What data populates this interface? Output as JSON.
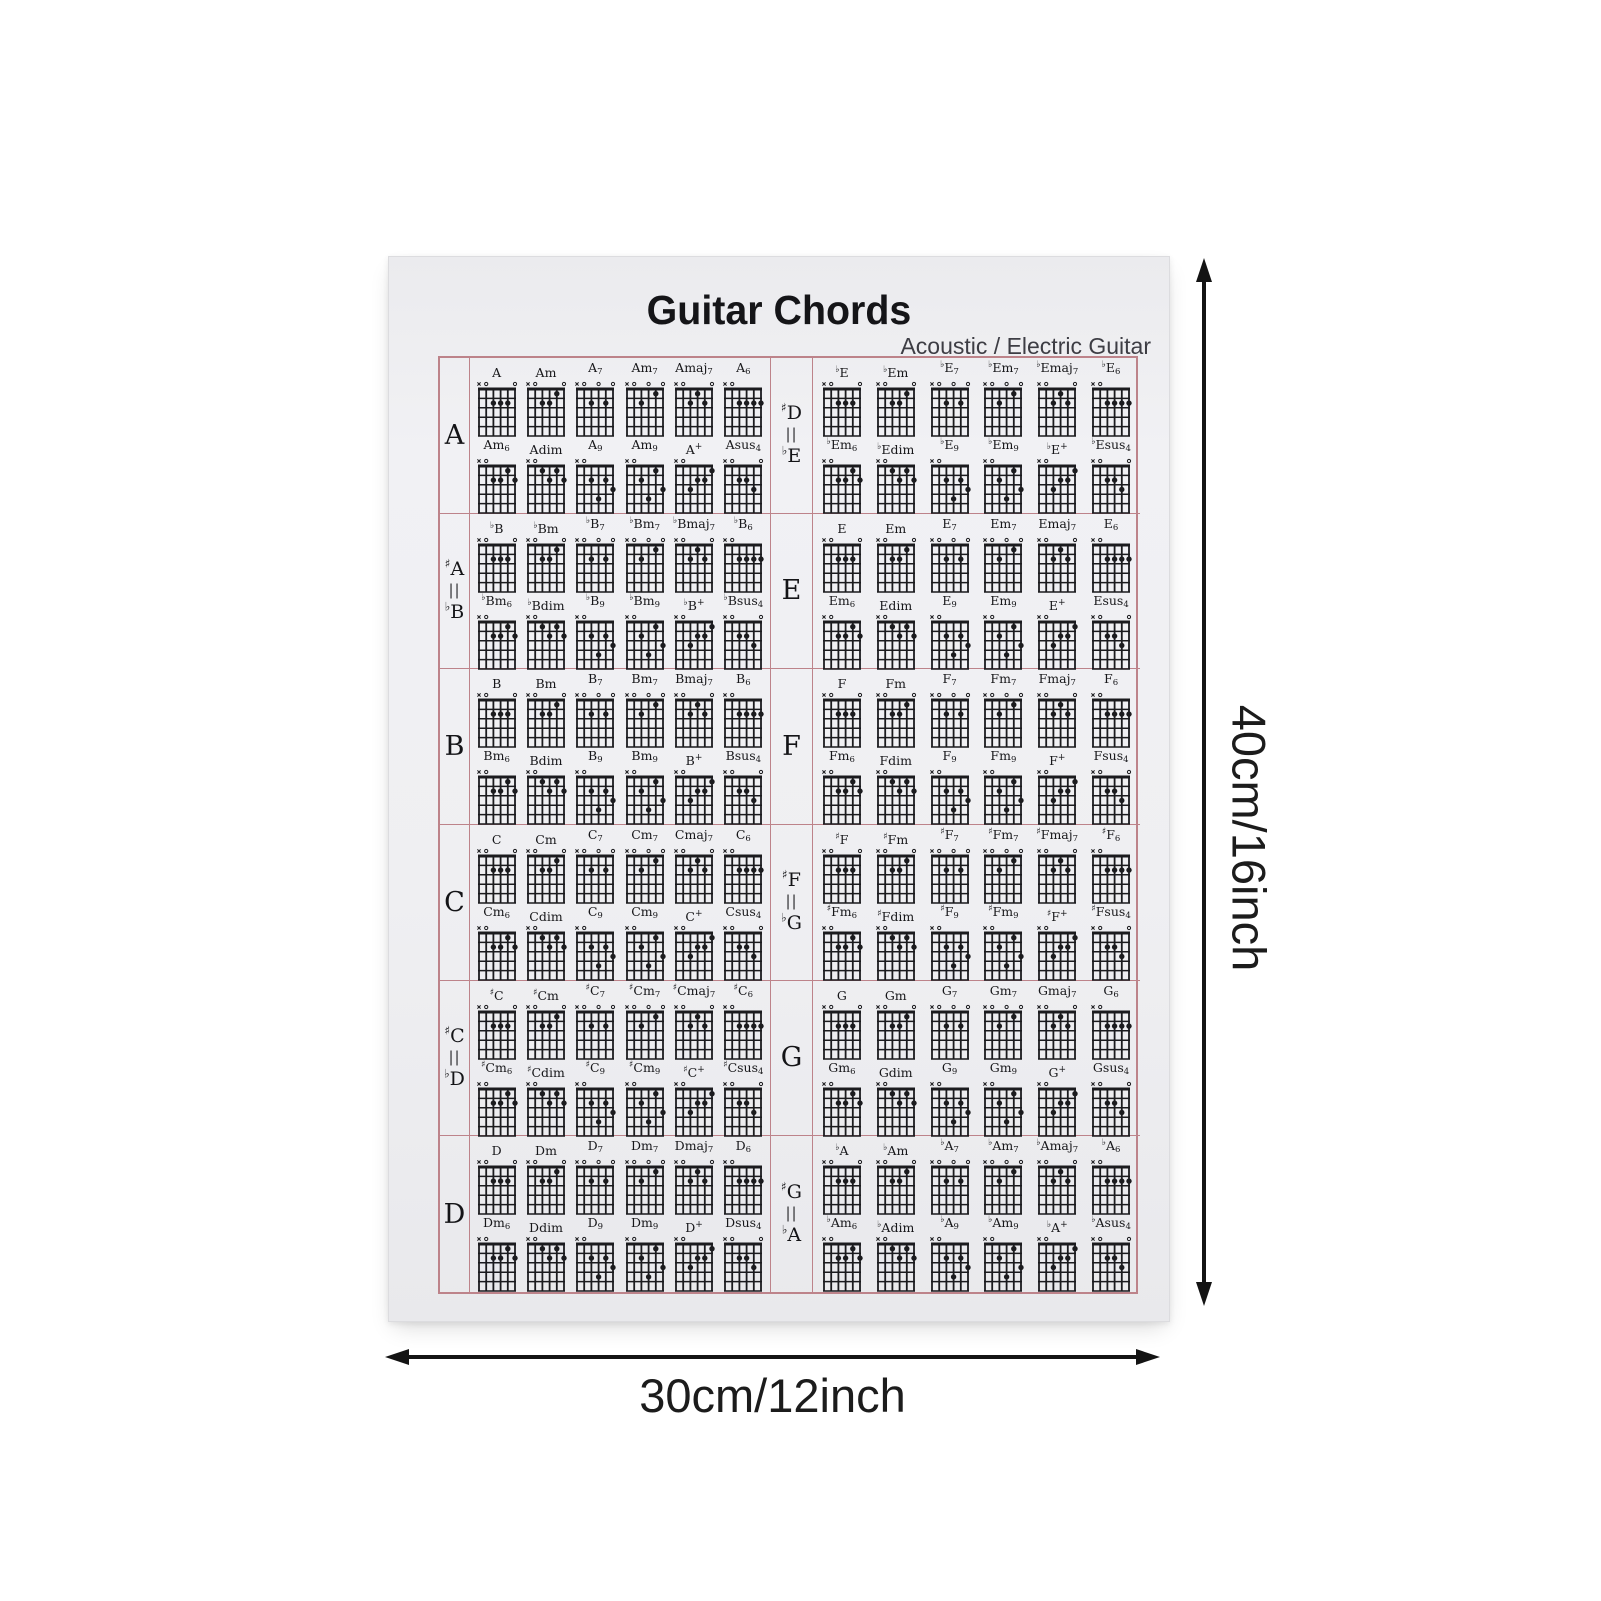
{
  "poster": {
    "title": "Guitar Chords",
    "subtitle": "Acoustic / Electric Guitar"
  },
  "dimension_labels": {
    "height": "40cm/16inch",
    "width": "30cm/12inch"
  },
  "colors": {
    "grid_border": "#bd838a",
    "ink": "#1b1b1e",
    "paper": "#efeff2"
  },
  "chord_suffixes": [
    {
      "mid": "",
      "sub": "",
      "sup": ""
    },
    {
      "mid": "m",
      "sub": "",
      "sup": ""
    },
    {
      "mid": "",
      "sub": "7",
      "sup": ""
    },
    {
      "mid": "m",
      "sub": "7",
      "sup": ""
    },
    {
      "mid": "maj",
      "sub": "7",
      "sup": ""
    },
    {
      "mid": "",
      "sub": "6",
      "sup": ""
    },
    {
      "mid": "m",
      "sub": "6",
      "sup": ""
    },
    {
      "mid": "dim",
      "sub": "",
      "sup": ""
    },
    {
      "mid": "",
      "sub": "9",
      "sup": ""
    },
    {
      "mid": "m",
      "sub": "9",
      "sup": ""
    },
    {
      "mid": "",
      "sub": "",
      "sup": "+"
    },
    {
      "mid": "sus",
      "sub": "4",
      "sup": ""
    }
  ],
  "columns": {
    "left": [
      {
        "label": [
          {
            "acc": "",
            "note": "A"
          }
        ],
        "chord_acc": "",
        "chord_root": "A"
      },
      {
        "label": [
          {
            "acc": "♯",
            "note": "A"
          },
          {
            "acc": "♭",
            "note": "B"
          }
        ],
        "chord_acc": "♭",
        "chord_root": "B"
      },
      {
        "label": [
          {
            "acc": "",
            "note": "B"
          }
        ],
        "chord_acc": "",
        "chord_root": "B"
      },
      {
        "label": [
          {
            "acc": "",
            "note": "C"
          }
        ],
        "chord_acc": "",
        "chord_root": "C"
      },
      {
        "label": [
          {
            "acc": "♯",
            "note": "C"
          },
          {
            "acc": "♭",
            "note": "D"
          }
        ],
        "chord_acc": "♯",
        "chord_root": "C"
      },
      {
        "label": [
          {
            "acc": "",
            "note": "D"
          }
        ],
        "chord_acc": "",
        "chord_root": "D"
      }
    ],
    "right": [
      {
        "label": [
          {
            "acc": "♯",
            "note": "D"
          },
          {
            "acc": "♭",
            "note": "E"
          }
        ],
        "chord_acc": "♭",
        "chord_root": "E"
      },
      {
        "label": [
          {
            "acc": "",
            "note": "E"
          }
        ],
        "chord_acc": "",
        "chord_root": "E"
      },
      {
        "label": [
          {
            "acc": "",
            "note": "F"
          }
        ],
        "chord_acc": "",
        "chord_root": "F"
      },
      {
        "label": [
          {
            "acc": "♯",
            "note": "F"
          },
          {
            "acc": "♭",
            "note": "G"
          }
        ],
        "chord_acc": "♯",
        "chord_root": "F"
      },
      {
        "label": [
          {
            "acc": "",
            "note": "G"
          }
        ],
        "chord_acc": "",
        "chord_root": "G"
      },
      {
        "label": [
          {
            "acc": "♯",
            "note": "G"
          },
          {
            "acc": "♭",
            "note": "A"
          }
        ],
        "chord_acc": "♭",
        "chord_root": "A"
      }
    ]
  },
  "diagram_patterns": [
    {
      "markers": "xo---o",
      "dots": [
        [
          3,
          2
        ],
        [
          4,
          2
        ],
        [
          5,
          2
        ]
      ]
    },
    {
      "markers": "xo---o",
      "dots": [
        [
          3,
          2
        ],
        [
          4,
          2
        ],
        [
          5,
          1
        ]
      ]
    },
    {
      "markers": "xo-o-o",
      "dots": [
        [
          3,
          2
        ],
        [
          5,
          2
        ]
      ]
    },
    {
      "markers": "xo-o-o",
      "dots": [
        [
          3,
          2
        ],
        [
          5,
          1
        ]
      ]
    },
    {
      "markers": "xo---o",
      "dots": [
        [
          3,
          2
        ],
        [
          4,
          1
        ],
        [
          5,
          2
        ]
      ]
    },
    {
      "markers": "xo----",
      "dots": [
        [
          3,
          2
        ],
        [
          4,
          2
        ],
        [
          5,
          2
        ],
        [
          6,
          2
        ]
      ]
    },
    {
      "markers": "xo----",
      "dots": [
        [
          3,
          2
        ],
        [
          4,
          2
        ],
        [
          5,
          1
        ],
        [
          6,
          2
        ]
      ]
    },
    {
      "markers": "xo----",
      "dots": [
        [
          3,
          1
        ],
        [
          4,
          2
        ],
        [
          5,
          1
        ],
        [
          6,
          2
        ]
      ]
    },
    {
      "markers": "xo----",
      "dots": [
        [
          3,
          2
        ],
        [
          4,
          4
        ],
        [
          5,
          2
        ],
        [
          6,
          3
        ]
      ]
    },
    {
      "markers": "xo----",
      "dots": [
        [
          3,
          2
        ],
        [
          4,
          4
        ],
        [
          5,
          1
        ],
        [
          6,
          3
        ]
      ]
    },
    {
      "markers": "xo----",
      "dots": [
        [
          3,
          3
        ],
        [
          4,
          2
        ],
        [
          5,
          2
        ],
        [
          6,
          1
        ]
      ]
    },
    {
      "markers": "xo---o",
      "dots": [
        [
          3,
          2
        ],
        [
          4,
          2
        ],
        [
          5,
          3
        ]
      ]
    }
  ]
}
